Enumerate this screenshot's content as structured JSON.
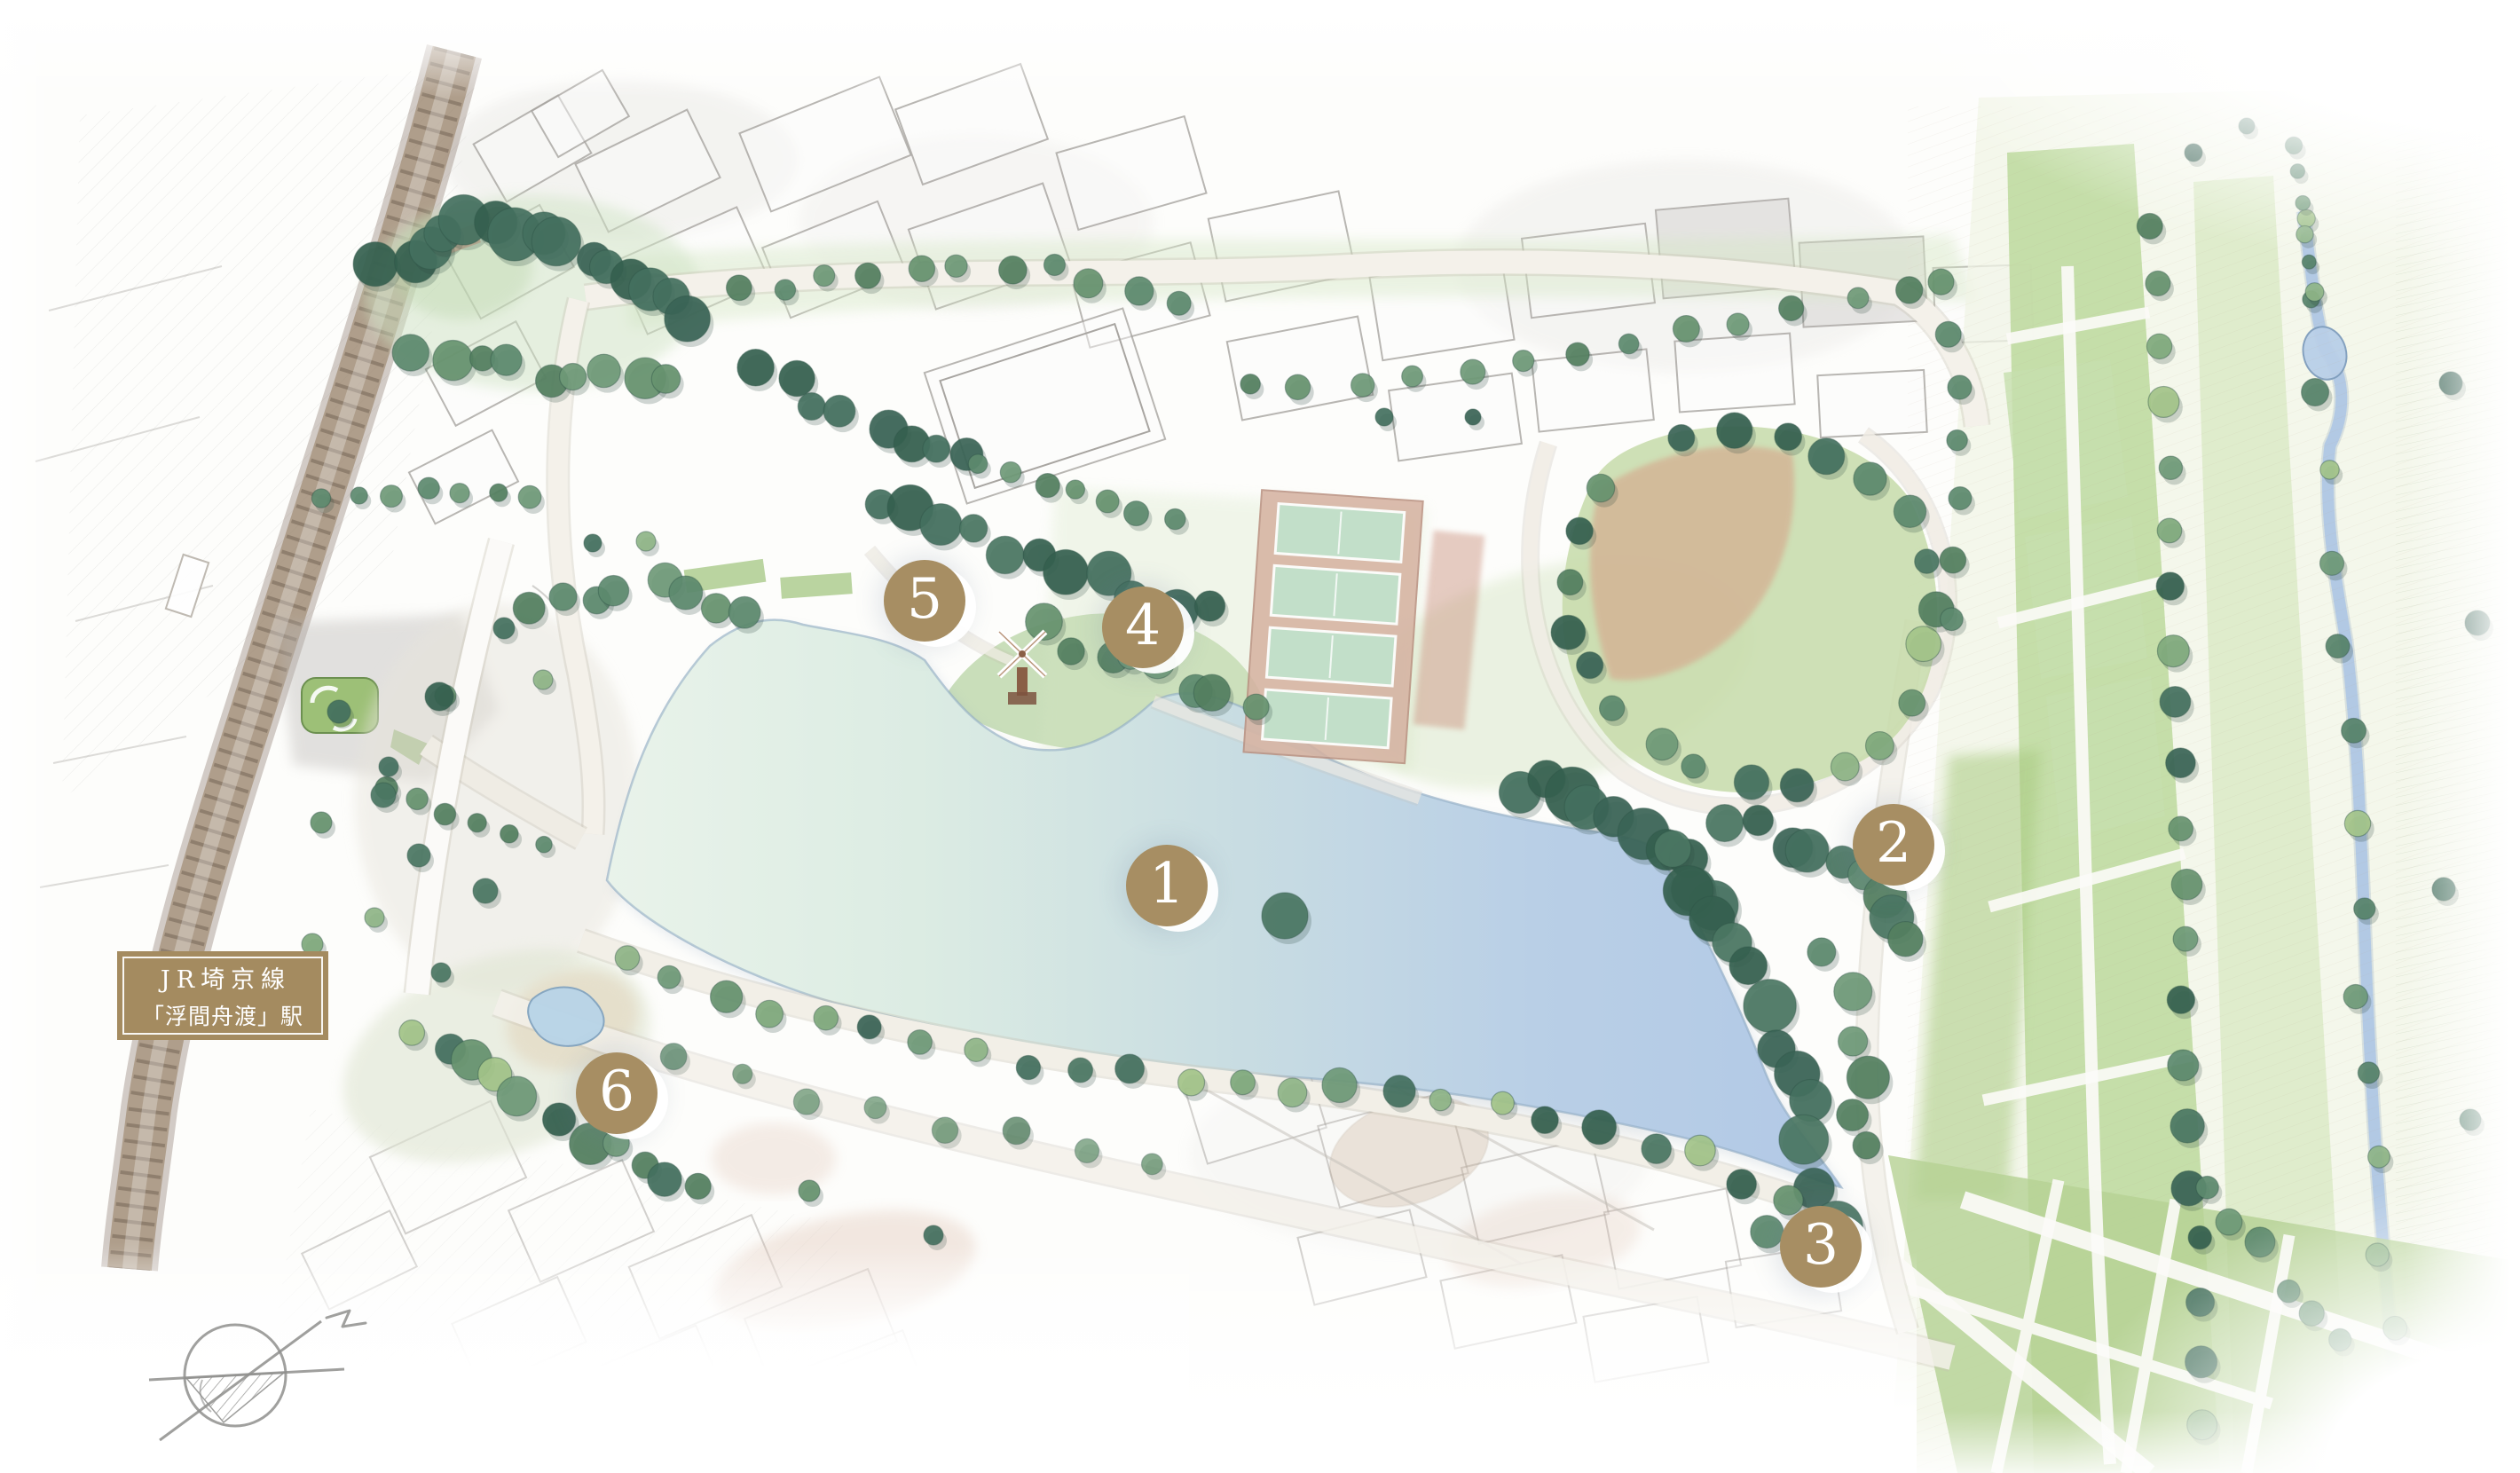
{
  "station_label": {
    "line1": "JR埼京線",
    "line2": "「浮間舟渡」駅"
  },
  "markers": [
    {
      "label": "1"
    },
    {
      "label": "2"
    },
    {
      "label": "3"
    },
    {
      "label": "4"
    },
    {
      "label": "5"
    },
    {
      "label": "6"
    }
  ],
  "icons": {
    "compass": "hand-drawn-compass-north-arrow",
    "windmill": "windmill-sculpture"
  },
  "colors": {
    "marker_badge": "#a78e63",
    "station_label_bg": "#a48b60",
    "lake_east_blue": "#b2c9e6",
    "lake_west_green": "#e9f3ea",
    "park_grass": "#c7dfae",
    "forest_green": "#44705f",
    "railway_brown": "#8d7764",
    "path_cream": "#f2efe7",
    "tennis_clay": "#d5b1a0",
    "infield_sand": "#d4b294",
    "pool_blue": "#b8d4e8"
  }
}
